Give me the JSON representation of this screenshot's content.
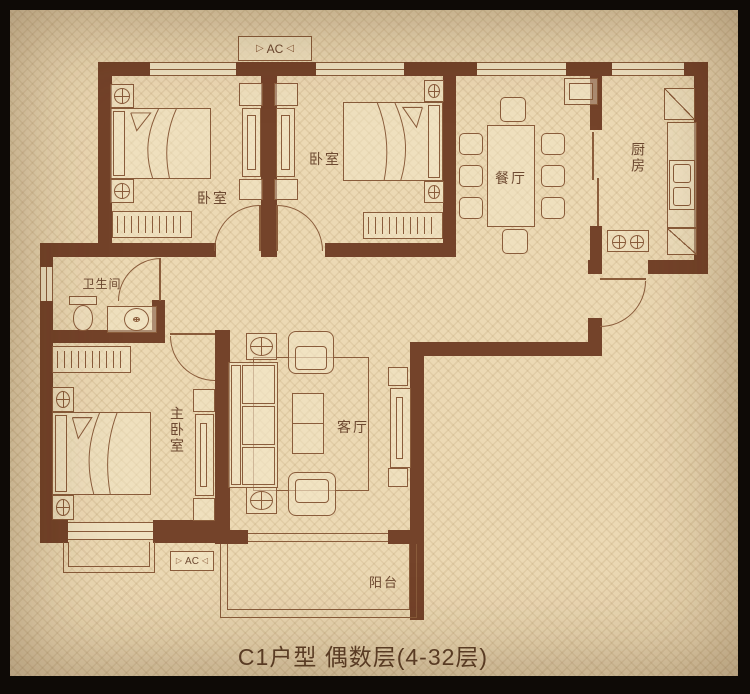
{
  "title": {
    "caption": "C1户型 偶数层(4-32层)"
  },
  "labels": {
    "bedroom1": "卧室",
    "bedroom2": "卧室",
    "dining": "餐厅",
    "kitchen": "厨房",
    "bathroom": "卫生间",
    "master": "主卧室",
    "living": "客厅",
    "balcony": "阳台",
    "ac": "AC"
  },
  "icons": {
    "ac_tri_left": "▷",
    "ac_tri_right": "◁"
  },
  "colors": {
    "frame": "#0e0a06",
    "paper": "#ecd9b4",
    "wall": "#74432a",
    "line": "#8a5c3b",
    "text": "#6d4931",
    "caption": "#5d3f28"
  }
}
